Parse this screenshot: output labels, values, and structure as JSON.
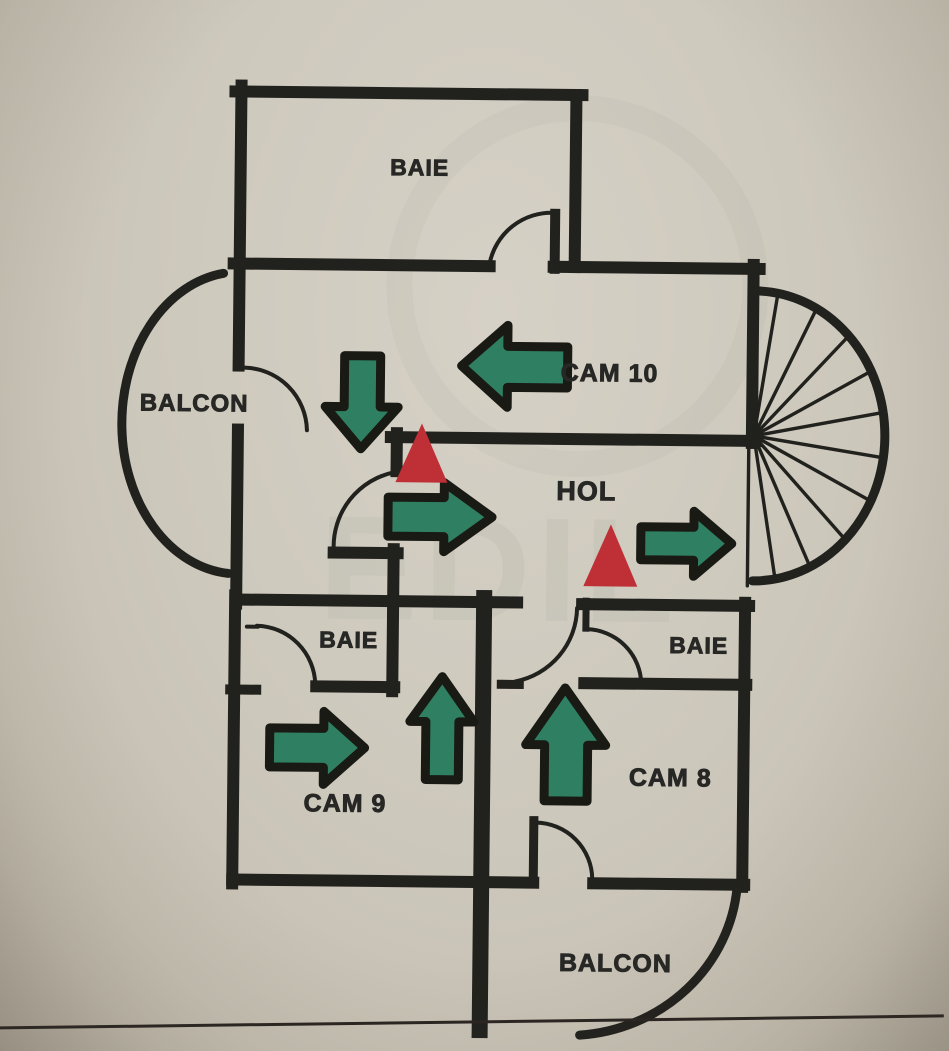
{
  "document": {
    "title": "Apartment floor plan sketch (Romanian labels)",
    "language": "ro"
  },
  "colors": {
    "paper": "#cdc8bc",
    "wall": "#21211d",
    "thin_line": "#2a2522",
    "arrow_green": "#2f8063",
    "arrow_outline": "#1a1a15",
    "triangle_red": "#bf3036",
    "label": "#272725",
    "watermark": "#6f7a72"
  },
  "rooms": [
    {
      "id": "baie-top",
      "label": "BAIE"
    },
    {
      "id": "balcon-left",
      "label": "BALCON"
    },
    {
      "id": "cam-10",
      "label": "CAM 10"
    },
    {
      "id": "hol",
      "label": "HOL"
    },
    {
      "id": "baie-mid-left",
      "label": "BAIE"
    },
    {
      "id": "baie-mid-right",
      "label": "BAIE"
    },
    {
      "id": "cam-9",
      "label": "CAM 9"
    },
    {
      "id": "cam-8",
      "label": "CAM 8"
    },
    {
      "id": "balcon-bottom",
      "label": "BALCON"
    }
  ],
  "markers": {
    "green_arrows": [
      {
        "id": "arrow-down",
        "direction": "down",
        "location": "corridor below CAM 10"
      },
      {
        "id": "arrow-left",
        "direction": "left",
        "location": "CAM 10"
      },
      {
        "id": "arrow-right-hol-center",
        "direction": "right",
        "location": "HOL center"
      },
      {
        "id": "arrow-right-hol-east",
        "direction": "right",
        "location": "HOL toward staircase"
      },
      {
        "id": "arrow-right-cam9",
        "direction": "right",
        "location": "CAM 9"
      },
      {
        "id": "arrow-up-cam9",
        "direction": "up",
        "location": "CAM 9 right side"
      },
      {
        "id": "arrow-up-cam8",
        "direction": "up",
        "location": "CAM 8 left side"
      }
    ],
    "red_triangles": [
      {
        "id": "triangle-hol-west",
        "location": "HOL west, above right arrow"
      },
      {
        "id": "triangle-hol-east",
        "location": "HOL east, left of exit arrow"
      }
    ]
  },
  "features": {
    "spiral_staircase": "right side semicircle with radial steps",
    "balcony_left": "semicircular",
    "balcony_bottom": "quarter-circle",
    "door_arcs": 7
  },
  "watermark": {
    "text": "EDIL"
  }
}
